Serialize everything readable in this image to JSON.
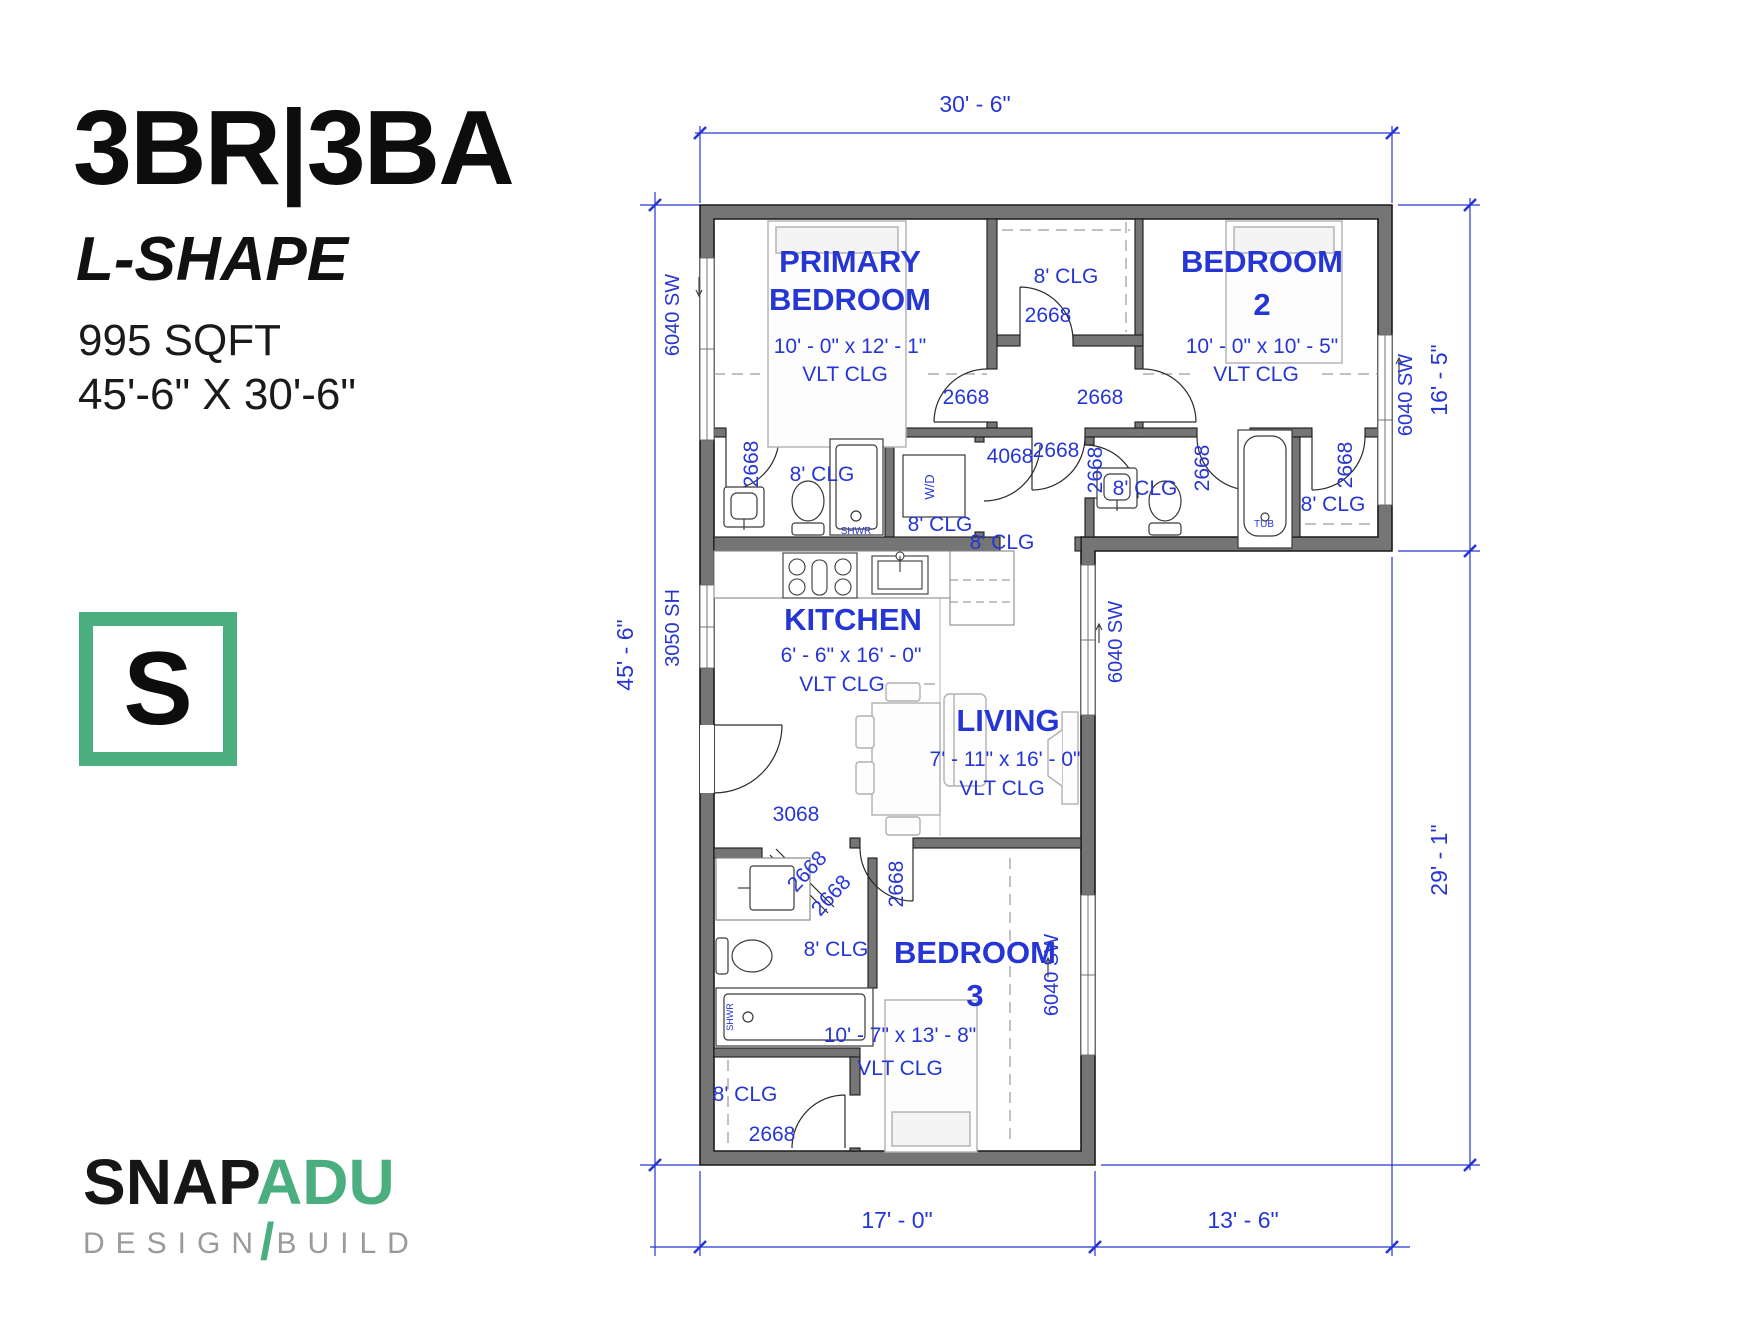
{
  "title_block": {
    "title": "3BR|3BA",
    "subtitle": "L-SHAPE",
    "sqft": "995 SQFT",
    "overall_dims": "45'-6\" X 30'-6\"",
    "logo_letter": "S"
  },
  "brand": {
    "name_black": "SNAP",
    "name_green": "ADU",
    "tagline_left": "DESIGN",
    "tagline_slash": "/",
    "tagline_right": "BUILD"
  },
  "colors": {
    "blue": "#2636d4",
    "wall_gray": "#757575",
    "wall_outline": "#1a1a1a",
    "brand_green": "#4bae7e",
    "tagline_gray": "#9a9a9a",
    "furniture_gray": "#b0b0b0",
    "dash_gray": "#9a9a9a"
  },
  "plan": {
    "labels": [
      {
        "id": "dim-top",
        "text": "30' - 6\"",
        "x": 975,
        "y": 112,
        "size": 23
      },
      {
        "id": "dim-left",
        "text": "45' - 6\"",
        "x": 633,
        "y": 655,
        "rot": -90,
        "size": 23
      },
      {
        "id": "dim-right-upper",
        "text": "16' - 5\"",
        "x": 1447,
        "y": 380,
        "rot": -90,
        "size": 23
      },
      {
        "id": "dim-right-lower",
        "text": "29' - 1\"",
        "x": 1447,
        "y": 860,
        "rot": -90,
        "size": 23
      },
      {
        "id": "dim-bottom-left",
        "text": "17' - 0\"",
        "x": 897,
        "y": 1228,
        "size": 23
      },
      {
        "id": "dim-bottom-right",
        "text": "13' - 6\"",
        "x": 1243,
        "y": 1228,
        "size": 23
      },
      {
        "id": "room-primary-name-1",
        "text": "PRIMARY",
        "x": 850,
        "y": 272,
        "size": 31,
        "bold": true
      },
      {
        "id": "room-primary-name-2",
        "text": "BEDROOM",
        "x": 850,
        "y": 310,
        "size": 31,
        "bold": true
      },
      {
        "id": "room-primary-dims",
        "text": "10' - 0\" x 12' - 1\"",
        "x": 850,
        "y": 353,
        "size": 21
      },
      {
        "id": "room-primary-clg",
        "text": "VLT CLG",
        "x": 845,
        "y": 381,
        "size": 21
      },
      {
        "id": "room-bedroom2-name-1",
        "text": "BEDROOM",
        "x": 1262,
        "y": 272,
        "size": 31,
        "bold": true
      },
      {
        "id": "room-bedroom2-name-2",
        "text": "2",
        "x": 1262,
        "y": 315,
        "size": 31,
        "bold": true
      },
      {
        "id": "room-bedroom2-dims",
        "text": "10' - 0\" x 10' - 5\"",
        "x": 1262,
        "y": 353,
        "size": 21
      },
      {
        "id": "room-bedroom2-clg",
        "text": "VLT CLG",
        "x": 1256,
        "y": 381,
        "size": 21
      },
      {
        "id": "room-kitchen-name",
        "text": "KITCHEN",
        "x": 853,
        "y": 630,
        "size": 31,
        "bold": true
      },
      {
        "id": "room-kitchen-dims",
        "text": "6' - 6\" x 16' - 0\"",
        "x": 851,
        "y": 662,
        "size": 21
      },
      {
        "id": "room-kitchen-clg",
        "text": "VLT CLG",
        "x": 842,
        "y": 691,
        "size": 21
      },
      {
        "id": "room-living-name",
        "text": "LIVING",
        "x": 1008,
        "y": 731,
        "size": 31,
        "bold": true
      },
      {
        "id": "room-living-dims",
        "text": "7' - 11\" x 16' - 0\"",
        "x": 1005,
        "y": 766,
        "size": 21
      },
      {
        "id": "room-living-clg",
        "text": "VLT CLG",
        "x": 1002,
        "y": 795,
        "size": 21
      },
      {
        "id": "room-bedroom3-name-1",
        "text": "BEDROOM",
        "x": 975,
        "y": 963,
        "size": 31,
        "bold": true
      },
      {
        "id": "room-bedroom3-name-2",
        "text": "3",
        "x": 975,
        "y": 1006,
        "size": 31,
        "bold": true
      },
      {
        "id": "room-bedroom3-dims",
        "text": "10' - 7\" x 13' - 8\"",
        "x": 900,
        "y": 1042,
        "size": 21
      },
      {
        "id": "room-bedroom3-clg",
        "text": "VLT CLG",
        "x": 900,
        "y": 1075,
        "size": 21
      },
      {
        "id": "window-primary",
        "text": "6040 SW",
        "x": 679,
        "y": 315,
        "rot": -90,
        "size": 20
      },
      {
        "id": "window-bedroom2",
        "text": "6040 SW",
        "x": 1412,
        "y": 395,
        "rot": -90,
        "size": 20
      },
      {
        "id": "window-living",
        "text": "6040 SW",
        "x": 1122,
        "y": 642,
        "rot": -90,
        "size": 20
      },
      {
        "id": "window-bedroom3",
        "text": "6040 SW",
        "x": 1058,
        "y": 975,
        "rot": -90,
        "size": 20
      },
      {
        "id": "window-kitchen",
        "text": "3050 SH",
        "x": 679,
        "y": 628,
        "rot": -90,
        "size": 20
      },
      {
        "id": "door-entry",
        "text": "3068",
        "x": 796,
        "y": 821,
        "size": 21
      },
      {
        "id": "closet-top-clg",
        "text": "8' CLG",
        "x": 1066,
        "y": 283,
        "size": 21
      },
      {
        "id": "closet-top-door",
        "text": "2668",
        "x": 1048,
        "y": 322,
        "size": 21
      },
      {
        "id": "door-primary",
        "text": "2668",
        "x": 966,
        "y": 404,
        "size": 21
      },
      {
        "id": "door-bedroom2",
        "text": "2668",
        "x": 1100,
        "y": 404,
        "size": 21
      },
      {
        "id": "door-wd",
        "text": "4068",
        "x": 1010,
        "y": 463,
        "size": 21
      },
      {
        "id": "door-lobby",
        "text": "2668",
        "x": 1056,
        "y": 457,
        "size": 21
      },
      {
        "id": "door-bath2",
        "text": "2668",
        "x": 1102,
        "y": 470,
        "rot": -90,
        "size": 21
      },
      {
        "id": "bath-primary-clg",
        "text": "8' CLG",
        "x": 822,
        "y": 481,
        "size": 21
      },
      {
        "id": "door-bath-primary",
        "text": "2668",
        "x": 758,
        "y": 464,
        "rot": -90,
        "size": 21
      },
      {
        "id": "wd-clg",
        "text": "8' CLG",
        "x": 940,
        "y": 531,
        "size": 21
      },
      {
        "id": "hall-clg",
        "text": "8' CLG",
        "x": 1002,
        "y": 549,
        "size": 21
      },
      {
        "id": "bath2-clg",
        "text": "8' CLG",
        "x": 1145,
        "y": 495,
        "size": 21
      },
      {
        "id": "door-bath2-bedroom",
        "text": "2668",
        "x": 1209,
        "y": 468,
        "rot": -90,
        "size": 21
      },
      {
        "id": "door-closet-bedroom2",
        "text": "2668",
        "x": 1352,
        "y": 465,
        "rot": -90,
        "size": 21
      },
      {
        "id": "closet-bedroom2-clg",
        "text": "8' CLG",
        "x": 1333,
        "y": 511,
        "size": 21
      },
      {
        "id": "tub-label",
        "text": "TUB",
        "x": 1264,
        "y": 527,
        "size": 10
      },
      {
        "id": "shwr-label",
        "text": "SHWR",
        "x": 856,
        "y": 534,
        "size": 10
      },
      {
        "id": "wd-label",
        "text": "W/D",
        "x": 934,
        "y": 487,
        "rot": -90,
        "size": 13
      },
      {
        "id": "door-bedroom3",
        "text": "2668",
        "x": 903,
        "y": 884,
        "rot": -90,
        "size": 21
      },
      {
        "id": "door-bath3-diag-1",
        "text": "2668",
        "x": 812,
        "y": 876,
        "rot": -47,
        "size": 21
      },
      {
        "id": "door-bath3-diag-2",
        "text": "2668",
        "x": 836,
        "y": 900,
        "rot": -47,
        "size": 21
      },
      {
        "id": "bath3-clg",
        "text": "8' CLG",
        "x": 836,
        "y": 956,
        "size": 21
      },
      {
        "id": "shwr3-label",
        "text": "SHWR",
        "x": 733,
        "y": 1017,
        "rot": -90,
        "size": 9
      },
      {
        "id": "closet-bedroom3-clg",
        "text": "8' CLG",
        "x": 745,
        "y": 1101,
        "size": 21
      },
      {
        "id": "door-closet-bedroom3",
        "text": "2668",
        "x": 772,
        "y": 1141,
        "size": 21
      }
    ]
  }
}
